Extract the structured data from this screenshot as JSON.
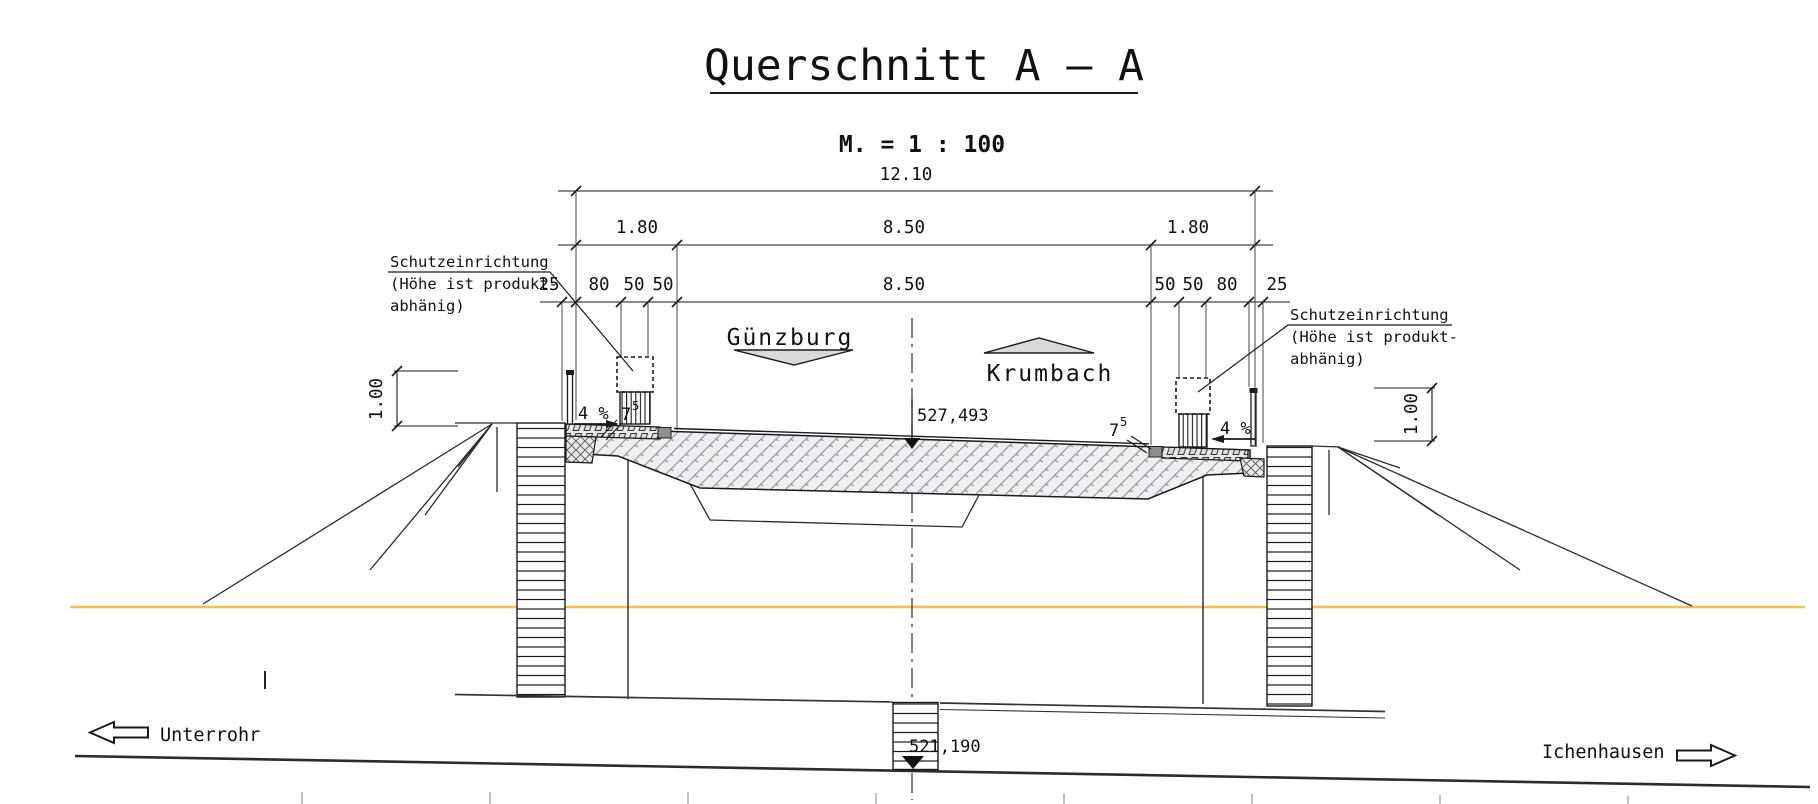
{
  "title": {
    "main": "Querschnitt A – A",
    "scale": "M. = 1 : 100"
  },
  "dimensions": {
    "total": "12.10",
    "row2": [
      "1.80",
      "8.50",
      "1.80"
    ],
    "row3": [
      "25",
      "80",
      "50",
      "50",
      "8.50",
      "50",
      "50",
      "80",
      "25"
    ],
    "height_left": "1.00",
    "height_right": "1.00"
  },
  "annotations": {
    "guard_left_line1": "Schutzeinrichtung",
    "guard_left_line2": "(Höhe ist produkt-",
    "guard_left_line3": "abhänig)",
    "guard_right_line1": "Schutzeinrichtung",
    "guard_right_line2": "(Höhe ist produkt-",
    "guard_right_line3": "abhänig)",
    "slope_left": "4 %",
    "slope_right": "4 %",
    "curb_left_base": "7",
    "curb_left_sup": "5",
    "curb_right_base": "7",
    "curb_right_sup": "5",
    "elevation_deck": "527,493",
    "elevation_base": "521,190"
  },
  "directions": {
    "upper_left": "Günzburg",
    "upper_right": "Krumbach",
    "lower_left": "Unterrohr",
    "lower_right": "Ichenhausen"
  },
  "colors": {
    "ink": "#1a1a1a",
    "ground_line": "#f2c14e",
    "triangle_fill": "#d9d9d9",
    "curb_fill": "#8f8f8f"
  }
}
